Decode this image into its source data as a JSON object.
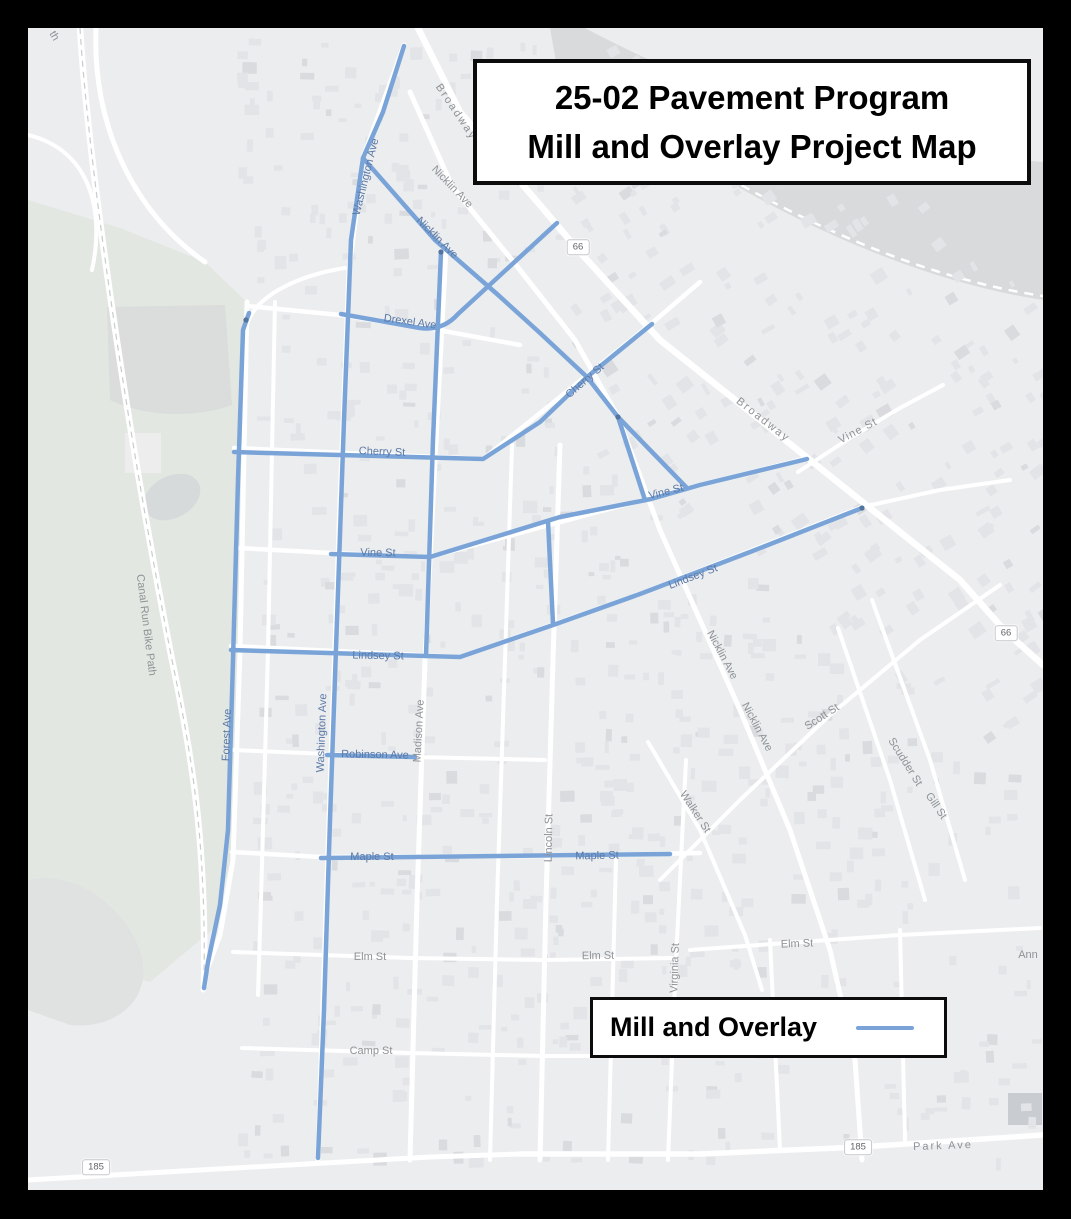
{
  "title": {
    "line1": "25-02 Pavement Program",
    "line2": "Mill and Overlay Project Map"
  },
  "legend": {
    "label": "Mill and Overlay",
    "line_color": "#7aa4d8"
  },
  "colors": {
    "route_blue": "#7aa4d8",
    "route_node": "#52749f",
    "map_bg": "#ebedef",
    "park": "#e3e7e2",
    "river": "#d8dadc",
    "road": "#ffffff",
    "building": "#e2e4e7",
    "frame": "#000000"
  },
  "shields": [
    {
      "text": "66",
      "x": 578,
      "y": 247
    },
    {
      "text": "66",
      "x": 1006,
      "y": 633
    },
    {
      "text": "185",
      "x": 96,
      "y": 1167
    },
    {
      "text": "185",
      "x": 858,
      "y": 1147
    }
  ],
  "labels": [
    {
      "t": "th",
      "x": 54,
      "y": 36,
      "r": 60,
      "c": "g"
    },
    {
      "t": "Broadway",
      "x": 456,
      "y": 112,
      "r": 56,
      "c": "g",
      "s": 2
    },
    {
      "t": "Nicklin Ave",
      "x": 452,
      "y": 187,
      "r": 46,
      "c": "g"
    },
    {
      "t": "Nicklin Ave",
      "x": 437,
      "y": 238,
      "r": 45,
      "c": "b"
    },
    {
      "t": "Washington Ave",
      "x": 366,
      "y": 177,
      "r": -76,
      "c": "b"
    },
    {
      "t": "Drexel Ave",
      "x": 410,
      "y": 322,
      "r": 8,
      "c": "b"
    },
    {
      "t": "Cherry St",
      "x": 585,
      "y": 381,
      "r": -41,
      "c": "b"
    },
    {
      "t": "Broadway",
      "x": 763,
      "y": 420,
      "r": 38,
      "c": "g",
      "s": 2
    },
    {
      "t": "Vine St",
      "x": 858,
      "y": 431,
      "r": -28,
      "c": "g",
      "s": 1
    },
    {
      "t": "Cherry St",
      "x": 382,
      "y": 452,
      "r": 2,
      "c": "b"
    },
    {
      "t": "Vine St",
      "x": 378,
      "y": 553,
      "r": 1,
      "c": "b"
    },
    {
      "t": "Vine St",
      "x": 666,
      "y": 492,
      "r": -14,
      "c": "b"
    },
    {
      "t": "Lindsey St",
      "x": 693,
      "y": 577,
      "r": -21,
      "c": "b"
    },
    {
      "t": "Lindsey St",
      "x": 378,
      "y": 656,
      "r": 1,
      "c": "b"
    },
    {
      "t": "Nicklin Ave",
      "x": 722,
      "y": 655,
      "r": 62,
      "c": "g"
    },
    {
      "t": "Nicklin Ave",
      "x": 757,
      "y": 727,
      "r": 62,
      "c": "g"
    },
    {
      "t": "Scott St",
      "x": 822,
      "y": 717,
      "r": -33,
      "c": "g"
    },
    {
      "t": "Scudder St",
      "x": 905,
      "y": 762,
      "r": 58,
      "c": "g"
    },
    {
      "t": "Gill St",
      "x": 936,
      "y": 806,
      "r": 56,
      "c": "g"
    },
    {
      "t": "Walker St",
      "x": 695,
      "y": 812,
      "r": 57,
      "c": "g"
    },
    {
      "t": "Forest Ave",
      "x": 227,
      "y": 735,
      "r": -88,
      "c": "b"
    },
    {
      "t": "Washington Ave",
      "x": 322,
      "y": 733,
      "r": -88,
      "c": "b"
    },
    {
      "t": "Madison Ave",
      "x": 419,
      "y": 731,
      "r": -87,
      "c": "g"
    },
    {
      "t": "Robinson Ave",
      "x": 375,
      "y": 755,
      "r": 1,
      "c": "b"
    },
    {
      "t": "Canal Run Bike Path",
      "x": 146,
      "y": 625,
      "r": 83,
      "c": "g"
    },
    {
      "t": "Lincoln St",
      "x": 549,
      "y": 838,
      "r": -89,
      "c": "g"
    },
    {
      "t": "Maple St",
      "x": 372,
      "y": 857,
      "r": 0,
      "c": "b"
    },
    {
      "t": "Maple St",
      "x": 597,
      "y": 856,
      "r": -1,
      "c": "b"
    },
    {
      "t": "Elm St",
      "x": 370,
      "y": 957,
      "r": 0,
      "c": "g"
    },
    {
      "t": "Elm St",
      "x": 598,
      "y": 956,
      "r": -1,
      "c": "g"
    },
    {
      "t": "Elm St",
      "x": 797,
      "y": 944,
      "r": -2,
      "c": "g"
    },
    {
      "t": "Virginia St",
      "x": 675,
      "y": 968,
      "r": -88,
      "c": "g"
    },
    {
      "t": "Ann",
      "x": 1028,
      "y": 955,
      "r": 0,
      "c": "g"
    },
    {
      "t": "Camp St",
      "x": 371,
      "y": 1051,
      "r": 0,
      "c": "g"
    },
    {
      "t": "Park Ave",
      "x": 943,
      "y": 1146,
      "r": -2,
      "c": "g",
      "s": 2
    }
  ],
  "map": {
    "routes": {
      "width": 4.5,
      "paths": [
        {
          "name": "washington-ave",
          "d": "M404,46 L383,112 L363,158 L351,240 L344,420 L337,620 L330,820 L324,1010 L318,1158"
        },
        {
          "name": "forest-ave",
          "d": "M249,313 L243,330 L238,480 L233,660 L228,830 L220,905 L208,962 L204,988"
        },
        {
          "name": "nicklin-ave",
          "d": "M363,158 L435,240 L497,294 L540,333 L587,377 L618,417"
        },
        {
          "name": "connector-a",
          "d": "M618,417 L645,500"
        },
        {
          "name": "connector-b",
          "d": "M618,417 L686,487"
        },
        {
          "name": "drexel-ave",
          "d": "M341,314 L420,328 Q443,331 458,314 L557,223"
        },
        {
          "name": "madison-ave",
          "d": "M441,252 L433,440 L426,656"
        },
        {
          "name": "cherry-st",
          "d": "M234,452 L340,455 L483,459 L540,422 L587,377 L652,324"
        },
        {
          "name": "vine-st",
          "d": "M331,554 L430,557 L560,517 L651,499 L700,485 L807,459"
        },
        {
          "name": "lincoln-st",
          "d": "M548,521 L553,624"
        },
        {
          "name": "lindsey-st",
          "d": "M231,650 L460,657 L556,624 L640,594 L750,552 L862,508"
        },
        {
          "name": "robinson-ave",
          "d": "M327,755 L415,757"
        },
        {
          "name": "maple-st",
          "d": "M321,858 L500,856 L670,854"
        }
      ],
      "nodes": [
        [
          618,
          417
        ],
        [
          246,
          320
        ],
        [
          862,
          508
        ],
        [
          441,
          252
        ]
      ]
    },
    "roads": [
      {
        "name": "broadway",
        "w": 6.5,
        "d": "M418,28 L460,112 L540,205 L578,250 L660,340 L764,423 L860,500 L960,580 L1006,632 L1043,665"
      },
      {
        "name": "nicklin-ave-road",
        "w": 5,
        "d": "M410,92 L452,186 L520,270 L575,340 L618,417 L660,530 L700,620 L740,710 L790,830 L830,950 L855,1060 L862,1160"
      },
      {
        "name": "washington-ave-road",
        "w": 5,
        "d": "M404,45 L363,158 L349,270 L340,500 L331,760 L323,1000 L318,1160"
      },
      {
        "name": "forest-ave-road",
        "w": 5,
        "d": "M247,302 L240,650 L233,860 L220,935 L205,975 L203,990"
      },
      {
        "name": "local-vertical",
        "w": 4,
        "d": "M275,302 L268,650 L261,900 L258,995"
      },
      {
        "name": "madison-ave-road",
        "w": 5,
        "d": "M446,248 L436,440 L425,660 L417,900 L410,1160"
      },
      {
        "name": "local-vertical",
        "w": 4,
        "d": "M512,445 L505,660 L497,900 L490,1160"
      },
      {
        "name": "lincoln-st-road",
        "w": 5,
        "d": "M560,445 L553,660 L546,900 L540,1160"
      },
      {
        "name": "virginia-st-road",
        "w": 4,
        "d": "M686,760 L676,960 L668,1160"
      },
      {
        "name": "local-vertical",
        "w": 4,
        "d": "M616,860 L608,1160"
      },
      {
        "name": "local-vertical",
        "w": 4,
        "d": "M770,940 L780,1150"
      },
      {
        "name": "local-vertical",
        "w": 4,
        "d": "M900,930 L905,1140"
      },
      {
        "name": "walker-st-road",
        "w": 4,
        "d": "M648,742 L700,830 L745,935 L762,990"
      },
      {
        "name": "scudder-st-road",
        "w": 4,
        "d": "M838,628 L890,780 L925,900"
      },
      {
        "name": "gill-st-road",
        "w": 4,
        "d": "M872,600 L930,760 L965,880"
      },
      {
        "name": "vine-st-road-ne",
        "w": 4,
        "d": "M798,472 L850,438 L900,408 L943,385"
      },
      {
        "name": "scott-st-road",
        "w": 4,
        "d": "M660,880 L740,800 L830,715 L920,640 L1000,585"
      },
      {
        "name": "lindsey-st-road",
        "w": 4,
        "d": "M862,507 L940,490 L1010,480"
      },
      {
        "name": "drexel-ave-road",
        "w": 4.5,
        "d": "M247,306 L340,315 L433,329 L520,345"
      },
      {
        "name": "cherry-st-road",
        "w": 4.5,
        "d": "M234,448 L483,459 L652,323 L700,282"
      },
      {
        "name": "vine-st-road",
        "w": 4.5,
        "d": "M238,548 L331,553 L430,557 L650,498 L807,458"
      },
      {
        "name": "lindsey-st-road-w",
        "w": 4.5,
        "d": "M231,646 L460,657 L640,594 L862,507"
      },
      {
        "name": "robinson-ave-road",
        "w": 4,
        "d": "M233,750 L327,754 L415,757 L545,760"
      },
      {
        "name": "maple-st-road",
        "w": 4.5,
        "d": "M232,852 L321,857 L540,856 L700,853"
      },
      {
        "name": "elm-st-road",
        "w": 4,
        "d": "M233,952 L410,958 L545,960 L672,958"
      },
      {
        "name": "elm-st-road-e",
        "w": 4,
        "d": "M690,950 L800,942 L900,935 L1040,928"
      },
      {
        "name": "camp-st-road",
        "w": 4,
        "d": "M242,1048 L410,1053 L545,1056 L672,1056"
      },
      {
        "name": "route-185-road",
        "w": 5,
        "d": "M28,1180 L200,1170 L430,1157 L520,1154"
      },
      {
        "name": "park-ave-road",
        "w": 5.5,
        "d": "M520,1154 L700,1154 L860,1147 L1043,1135"
      },
      {
        "name": "park-loop-road",
        "w": 5,
        "d": "M96,28 C92,120 130,210 205,262"
      },
      {
        "name": "park-loop-road",
        "w": 4,
        "d": "M28,135 C90,150 105,210 92,270"
      },
      {
        "name": "park-loop-road",
        "w": 4,
        "d": "M247,325 C255,295 300,275 345,268"
      },
      {
        "name": "canal-run-bike-path",
        "w": 6.5,
        "d": "M80,28 C88,160 125,420 172,660 C195,770 206,850 204,985"
      }
    ]
  }
}
